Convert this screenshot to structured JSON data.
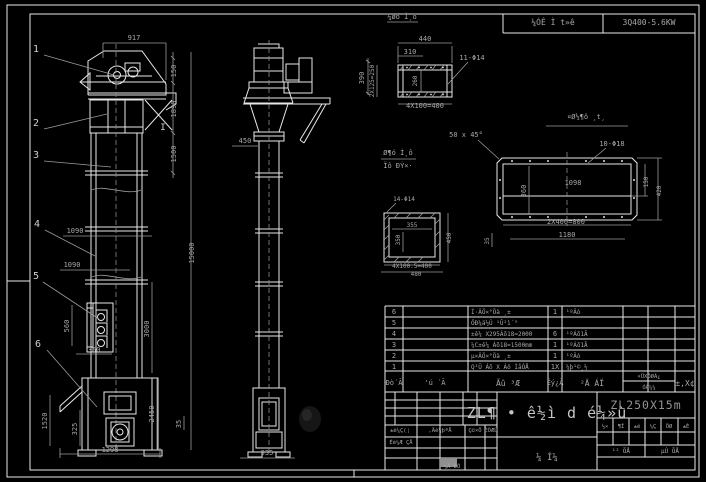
{
  "top_strip": {
    "cell1": "¼ÓÊ Ì t»ê",
    "cell2": "3Q400-5.6KW"
  },
  "balloons": {
    "b1": "1",
    "b2": "2",
    "b3": "3",
    "b4": "4",
    "b5": "5",
    "b6": "6",
    "section_mark": "I"
  },
  "front_dims": {
    "w917": "917",
    "h150": "150",
    "h1890": "1890",
    "h1500": "1500",
    "total15000": "15000",
    "h3000": "3000",
    "h2450": "2450",
    "h35": "35",
    "w1090a": "1090",
    "w1090b": "1090",
    "h1520": "1520",
    "h325": "325",
    "w1298": "1298",
    "h560": "560",
    "w360": "360"
  },
  "side_dims": {
    "w450": "450",
    "w935": "935",
    "h390": "390"
  },
  "channel_detail": {
    "title": "¼øó Ì¸ô",
    "d440": "440",
    "d310": "310",
    "left": "2X125=250",
    "inner": "260",
    "holes": "11-Φ14",
    "bottom": "4X100=400"
  },
  "square_detail": {
    "title1": "Ø¶ó Ì¸ô",
    "title2": "Ïô ÐÝ×·",
    "holes": "14-Φ14",
    "w355": "355",
    "h350": "350",
    "r450": "450",
    "b400": "4X100.5=400",
    "b480": "480"
  },
  "flange_detail": {
    "title": "¤Ø½¶ô ¸t¸",
    "chamfer": "50 x 45°",
    "holes": "10-Φ18",
    "w1098": "1098",
    "h360": "360",
    "r150": "150",
    "r420": "420",
    "b800": "2X400=800",
    "b1180": "1180",
    "h35": "35"
  },
  "bom": {
    "rows": [
      {
        "no": "6",
        "code": "",
        "name": "Í·ÂÖ×°Öà ¸±",
        "qty": "1",
        "mat": "¹ºÂò"
      },
      {
        "no": "5",
        "code": "",
        "name": "ÖÐ¼ä½Ú ¹Û²ì´°",
        "qty": "",
        "mat": ""
      },
      {
        "no": "4",
        "code": "",
        "name": "±ê¼ X295Áõ18=2000",
        "qty": "6",
        "mat": "¹ºÁõ1Ã"
      },
      {
        "no": "3",
        "code": "",
        "name": "¼C±ê¼ Áõ18=1500mm",
        "qty": "1",
        "mat": "¹ºÁõ1Ã"
      },
      {
        "no": "2",
        "code": "",
        "name": "µ×ÂÖ×°Öà ¸±",
        "qty": "1",
        "mat": "¹ºÂò"
      },
      {
        "no": "1",
        "code": "",
        "name": "Q¹Ü Áõ X Áô ÌåÓÅ",
        "qty": "1X",
        "mat": "¼þ¹©¸½"
      }
    ],
    "headers": {
      "no": "Ðò´Ã",
      "code": "'ú ´Ã",
      "name": "Ãû ³Æ",
      "qty": "Êý¿Ã",
      "mat": "²Ä ÁÏ",
      "weight_top": "×ÜXÖØÁ¿",
      "weight_bottom": "ÓÃ¼¼",
      "remark": "±,X¢"
    }
  },
  "titleblock": {
    "product": "ZL¶ • ê½ì d é¼»ù",
    "model": "ZL250X15m",
    "rev_labels": {
      "l1": "±ê¼Ç(¦",
      "l2": ",Äê¼þºÅ",
      "l3": "Ç©×Ö",
      "l4": "ÈÕÆÚ",
      "design": "Éè¼Æ ÇÅ",
      "date": "¼Ä ÈÕ"
    },
    "stage_cells": [
      "½×",
      "¶Î",
      "±ê",
      "¼Ç",
      "ÖØ",
      "±È"
    ],
    "sheet_total": "¹² ÕÅ",
    "sheet_no": "µÚ ÕÅ",
    "drawing_type": "¼ Í¼"
  }
}
